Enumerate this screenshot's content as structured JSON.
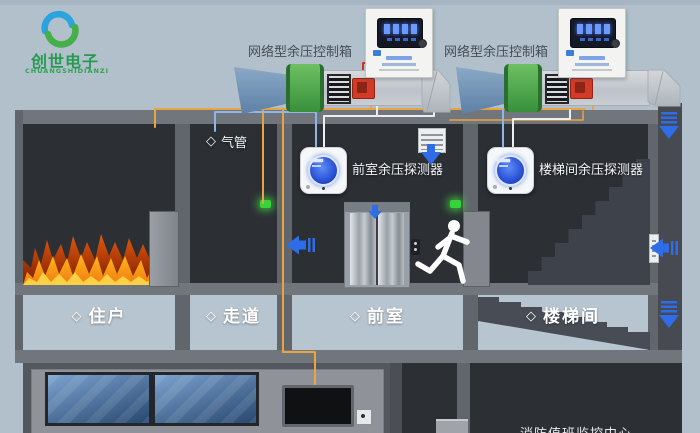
{
  "logo": {
    "title": "创世电子",
    "subtitle": "CHUANGSHIDIANZI"
  },
  "control_boxes": {
    "left_label": "网络型余压控制箱",
    "right_label": "网络型余压控制箱"
  },
  "detectors": {
    "front_label": "前室余压探测器",
    "stair_label": "楼梯间余压探测器"
  },
  "pipe": {
    "diamond": "◇",
    "label": "气管"
  },
  "rooms": [
    {
      "diamond": "◇",
      "label": "住户"
    },
    {
      "diamond": "◇",
      "label": "走道"
    },
    {
      "diamond": "◇",
      "label": "前室"
    },
    {
      "diamond": "◇",
      "label": "楼梯间"
    }
  ],
  "bottom": {
    "partial_label": "消防值班监控中心"
  },
  "colors": {
    "background": "#b1c0cb",
    "room_dark": "#2c2f34",
    "wall_gray": "#61666d",
    "slab_gray": "#71767d",
    "arrow_blue": "#2f6ce8",
    "wire_orange": "#e9a43f",
    "wire_red": "#d8311f",
    "tube_blue": "#8fb6e8",
    "wire_white": "#eceff1",
    "fan_green": "#4aa54a",
    "logo_green": "#2da44e",
    "logo_blue": "#2ba3dc",
    "fire_orange": "#f07818",
    "detector_screen_blue": "#2a50d8",
    "panel_screen_blue": "#3f68a0"
  }
}
